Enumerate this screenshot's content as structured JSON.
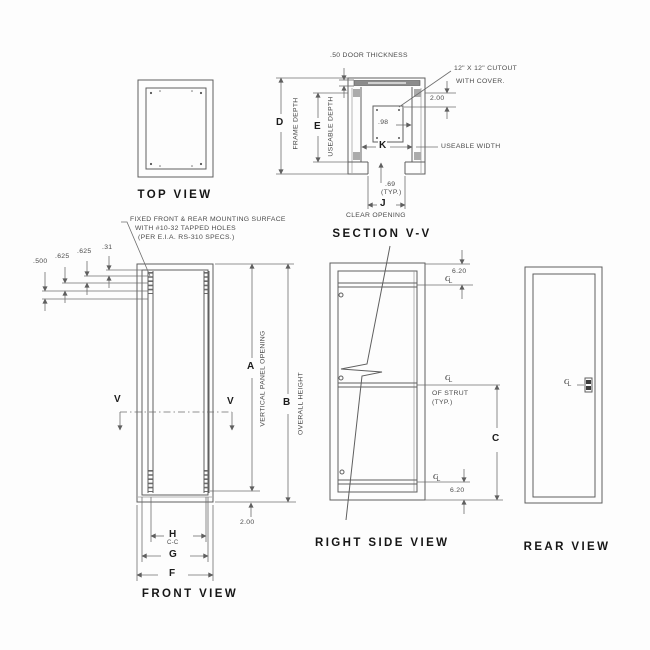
{
  "views": {
    "top": {
      "title": "TOP VIEW"
    },
    "section": {
      "title": "SECTION V-V",
      "door_thickness_note": ".50 DOOR THICKNESS",
      "cutout_note_line1": "12\" X 12\" CUTOUT",
      "cutout_note_line2": "WITH COVER.",
      "dim_2_00": "2.00",
      "dim_98": ".98",
      "dim_k": "K",
      "useable_width": "USEABLE WIDTH",
      "dim_69": ".69",
      "dim_69_typ": "(TYP.)",
      "dim_j": "J",
      "clear_opening": "CLEAR OPENING",
      "dim_d": "D",
      "frame_depth": "FRAME DEPTH",
      "dim_e": "E",
      "useable_depth": "USEABLE DEPTH"
    },
    "front": {
      "title": "FRONT VIEW",
      "note_line1": "FIXED FRONT & REAR MOUNTING SURFACE",
      "note_line2": "WITH #10-32 TAPPED HOLES",
      "note_line3": "(PER E.I.A. RS-310 SPECS.)",
      "hole_dims": [
        ".500",
        ".625",
        ".625",
        ".31"
      ],
      "section_marker": "V",
      "dim_a": "A",
      "vertical_panel_opening": "VERTICAL PANEL OPENING",
      "dim_b": "B",
      "overall_height": "OVERALL HEIGHT",
      "dim_2_00": "2.00",
      "dim_h": "H",
      "dim_h_sub": "C-C",
      "dim_g": "G",
      "dim_f": "F"
    },
    "side": {
      "title": "RIGHT SIDE VIEW",
      "dim_top": "6.20",
      "dim_bottom": "6.20",
      "strut_note_line1": "OF STRUT",
      "strut_note_line2": "(TYP.)",
      "dim_c": "C"
    },
    "rear": {
      "title": "REAR VIEW"
    }
  }
}
